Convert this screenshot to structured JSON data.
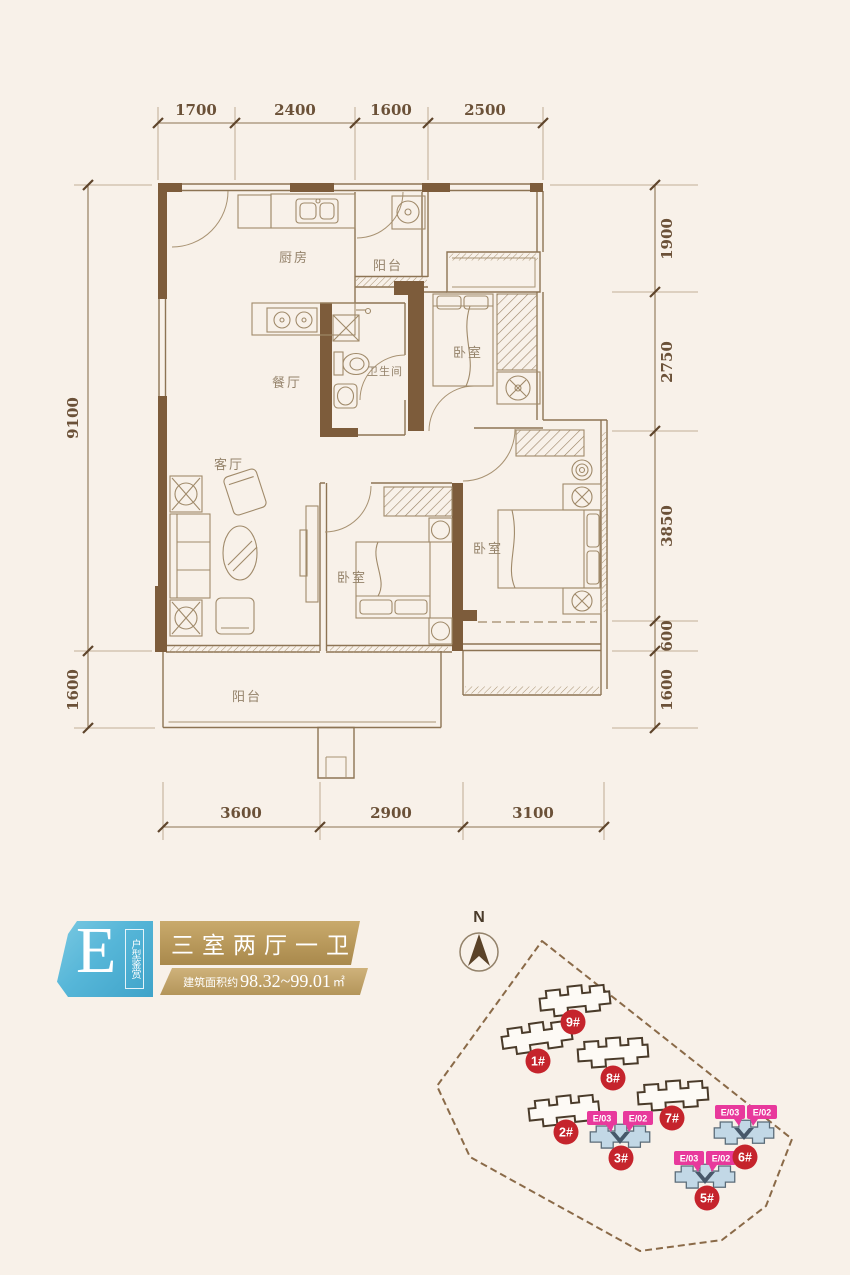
{
  "colors": {
    "background": "#f8f1e9",
    "wall_brown": "#7d5c3b",
    "line_brown": "#9a8264",
    "dim_text": "#6b5138",
    "badge_blue": "#56b6d8",
    "banner_gold": "#b2924f",
    "banner_gold_light": "#c3a76b",
    "building_red": "#c5242c",
    "tag_pink": "#e8399c",
    "highlight_blue": "#c2d8e6"
  },
  "floorplan": {
    "dimensions": {
      "top": [
        "1700",
        "2400",
        "1600",
        "2500"
      ],
      "left": [
        "9100",
        "1600"
      ],
      "right": [
        "1900",
        "2750",
        "3850",
        "600",
        "1600"
      ],
      "bottom": [
        "3600",
        "2900",
        "3100"
      ]
    },
    "rooms": {
      "kitchen": "厨房",
      "balcony_top": "阳台",
      "bathroom": "卫生间",
      "bedroom_top_right": "卧室",
      "dining": "餐厅",
      "living": "客厅",
      "bedroom_middle": "卧室",
      "bedroom_bottom_right": "卧室",
      "balcony_bottom": "阳台"
    }
  },
  "legend": {
    "unit_letter": "E",
    "unit_label": "户型鉴赏",
    "layout_title": "三室两厅一卫",
    "area_prefix": "建筑面积约",
    "area_value": "98.32~99.01",
    "area_unit": "㎡"
  },
  "sitemap": {
    "north_label": "N",
    "buildings": [
      {
        "id": "9#"
      },
      {
        "id": "1#"
      },
      {
        "id": "8#"
      },
      {
        "id": "2#"
      },
      {
        "id": "7#"
      },
      {
        "id": "3#",
        "tags": [
          "E/03",
          "E/02"
        ]
      },
      {
        "id": "6#",
        "tags": [
          "E/03",
          "E/02"
        ]
      },
      {
        "id": "5#",
        "tags": [
          "E/03",
          "E/02"
        ]
      }
    ]
  }
}
